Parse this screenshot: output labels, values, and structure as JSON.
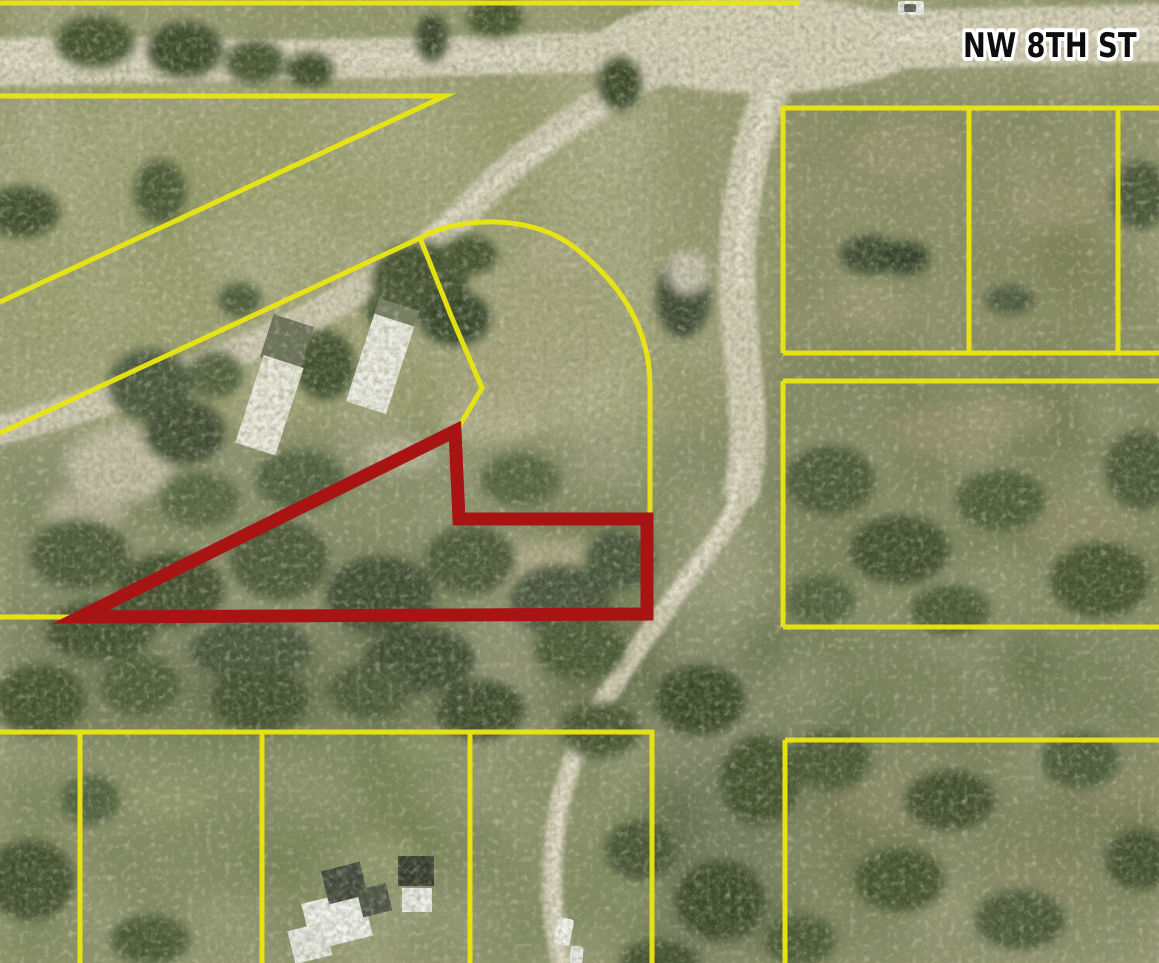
{
  "map": {
    "kind": "aerial-parcel-map",
    "street_label": "NW 8TH ST",
    "colors": {
      "parcel_boundary_line": "#e9e512",
      "subject_parcel_outline": "#a81414",
      "street_label_text": "#0d0d0d",
      "street_label_halo": "#ffffff"
    }
  }
}
